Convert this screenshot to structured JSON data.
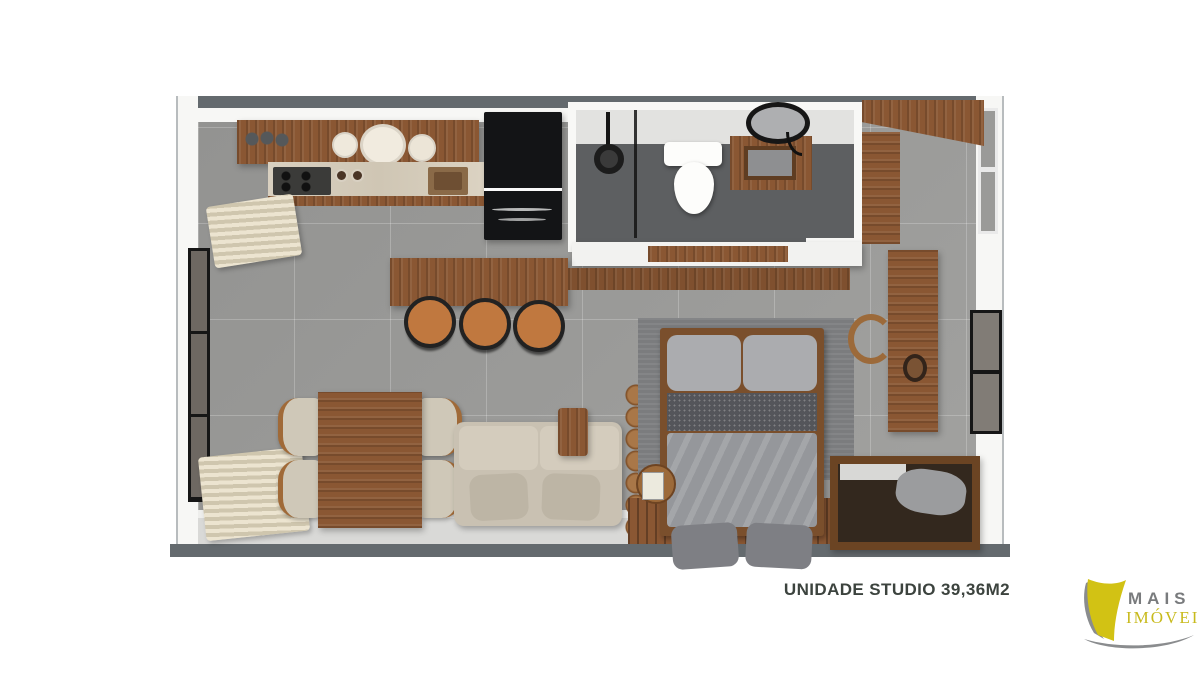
{
  "caption": {
    "label": "UNIDADE STUDIO 39,36M2"
  },
  "logo": {
    "name": "MAIS",
    "suffix": "IMÓVEIS"
  },
  "colors": {
    "background": "#ffffff",
    "wall_cap": "#646a6e",
    "wall_fill": "#f7f7f5",
    "floor_tile": "#9c9c9a",
    "balcony_floor": "#d9d9d7",
    "bathroom_floor": "#5d5f61",
    "wood": "#8a5733",
    "wood_dark": "#6b4423",
    "marble": "#d6cdbd",
    "appliance_black": "#131416",
    "fabric_beige": "#c9c1b2",
    "bedding_gray": "#95979b",
    "bedding_dark": "#54555a",
    "stool_tan": "#c0783f",
    "curtain": "#e6decb",
    "logo_yellow": "#c8ba1c",
    "logo_gray": "#797b7d",
    "caption_text": "#3c433e"
  },
  "floorplan": {
    "rooms": [
      "kitchen",
      "bathroom",
      "closet",
      "living-dining",
      "sleeping-area",
      "balcony"
    ],
    "furniture": [
      "kitchen-shelf",
      "cooktop",
      "kitchen-sink",
      "refrigerator",
      "shower",
      "toilet",
      "vanity",
      "round-mirror",
      "wardrobe",
      "bar-counter",
      "bar-stools",
      "dining-table",
      "dining-chairs",
      "sofa",
      "side-table",
      "decor-ladder",
      "double-bed",
      "rug",
      "nightstand",
      "wood-deck",
      "desk",
      "desk-chair",
      "storage-chest",
      "windows",
      "curtains"
    ]
  }
}
